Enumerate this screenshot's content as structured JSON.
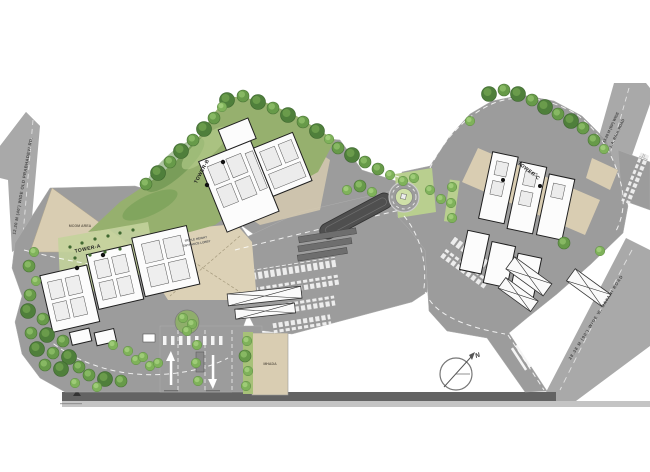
{
  "towers": {
    "a": "TOWER-A",
    "b": "TOWER-B",
    "c": "TOWER-C"
  },
  "roads": {
    "old_prabhadevi": "12.20 M (40') WIDE OLD PRABHADEVI RD.",
    "ja_raul": {
      "line1": "13.28 M (BP) WIDE",
      "line2": "J. A. RAUL ROAD"
    },
    "sayani": "28.38 M (90') WIDE  W. SAYANI ROAD"
  },
  "areas": {
    "mcgm": "MCGM AREA",
    "mhada": "MHADA",
    "lobby": {
      "line1": "TRIPLE HEIGHT",
      "line2": "ENTRANCE LOBBY"
    }
  },
  "compass": {
    "north": "N"
  },
  "colors": {
    "road": "#a9a9a9",
    "site_paving": "#9c9c9c",
    "beige": "#d9cdb2",
    "green_band": "#96b06e",
    "green_light": "#c3d39b",
    "tree_dark": "#4f7f3b",
    "tree_mid": "#679a49",
    "tree_light": "#7fb25a",
    "ramp_dark": "#4f4f4f",
    "building_outline": "#1f1f1f",
    "bottom_strip": "#636363"
  }
}
